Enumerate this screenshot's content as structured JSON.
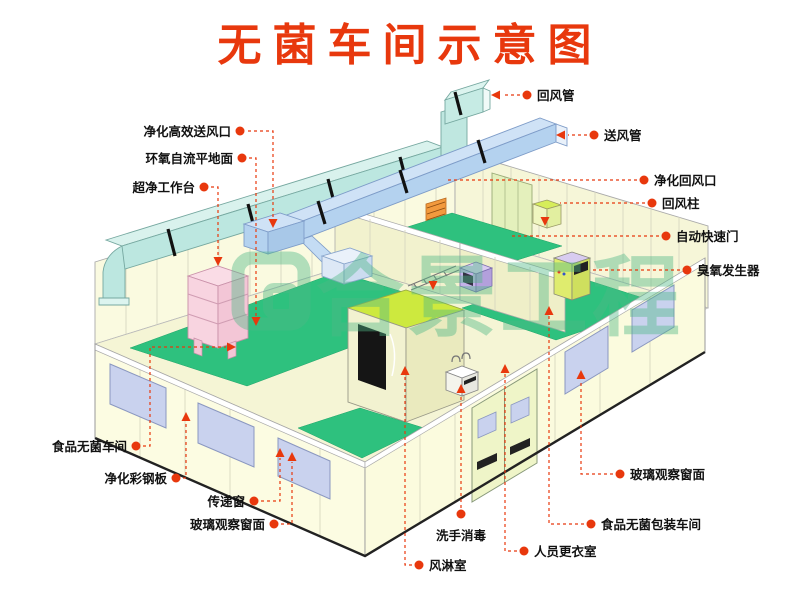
{
  "title": "无菌车间示意图",
  "watermark": {
    "text": "合景工程"
  },
  "colors": {
    "title_red": "#E8380D",
    "leader_red": "#E8380D",
    "wall_yellow": "#FAFAE0",
    "floor_green": "#2EC17E",
    "lime_green": "#CDE93E",
    "duct_cyan": "#C6EBE4",
    "duct_blue": "#BDD7F2",
    "window_lavender": "#C9D2EE",
    "watermark_green": "#4FB886",
    "bench_pink": "#F8D6E2"
  },
  "labels": {
    "left": [
      {
        "text": "净化高效送风口"
      },
      {
        "text": "环氧自流平地面"
      },
      {
        "text": "超净工作台"
      },
      {
        "text": "食品无菌车间"
      },
      {
        "text": "净化彩钢板"
      },
      {
        "text": "传递窗"
      },
      {
        "text": "玻璃观察窗面"
      }
    ],
    "right": [
      {
        "text": "回风管"
      },
      {
        "text": "送风管"
      },
      {
        "text": "净化回风口"
      },
      {
        "text": "回风柱"
      },
      {
        "text": "自动快速门"
      },
      {
        "text": "臭氧发生器"
      },
      {
        "text": "玻璃观察窗面"
      },
      {
        "text": "食品无菌包装车间"
      },
      {
        "text": "人员更衣室"
      }
    ],
    "bottom": [
      {
        "text": "洗手消毒"
      },
      {
        "text": "风淋室"
      }
    ]
  }
}
